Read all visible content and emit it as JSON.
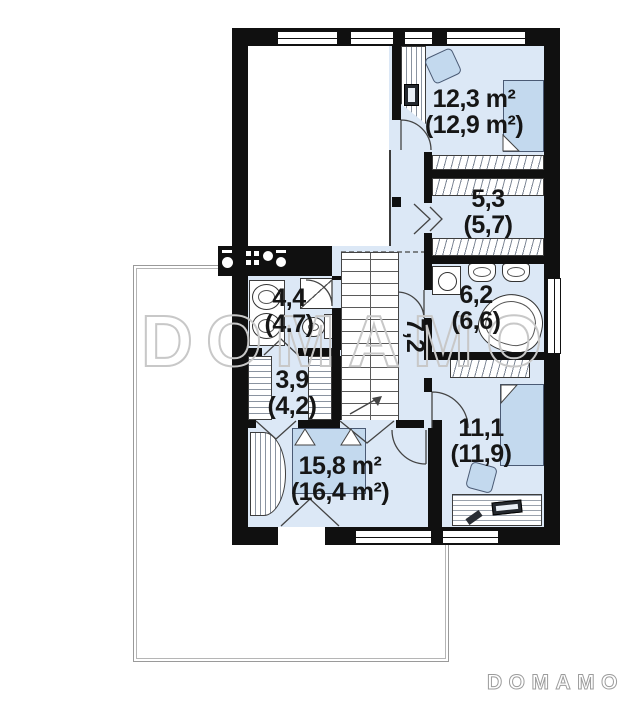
{
  "plan": {
    "rooms": [
      {
        "key": "bedroom-upper-right",
        "area": "12,3 m²",
        "area_gross": "(12,9 m²)"
      },
      {
        "key": "wardrobe",
        "area": "5,3",
        "area_gross": "(5,7)"
      },
      {
        "key": "bathroom-upper-right",
        "area": "6,2",
        "area_gross": "(6,6)"
      },
      {
        "key": "hallway",
        "area": "7,2",
        "area_gross": ""
      },
      {
        "key": "bathroom-left",
        "area": "4,4",
        "area_gross": "(4.7)"
      },
      {
        "key": "closet",
        "area": "3,9",
        "area_gross": "(4,2)"
      },
      {
        "key": "bedroom-lower-left",
        "area": "15,8 m²",
        "area_gross": "(16,4 m²)"
      },
      {
        "key": "bedroom-lower-right",
        "area": "11,1",
        "area_gross": "(11,9)"
      }
    ]
  },
  "watermark_text": "DOMAMO",
  "logo_text": "DOMAMO",
  "colors": {
    "wall": "#101010",
    "room_fill": "#dce8f6",
    "furniture_fill": "#c3d9ee",
    "watermark": "#c8c8c8",
    "line": "#444444"
  }
}
